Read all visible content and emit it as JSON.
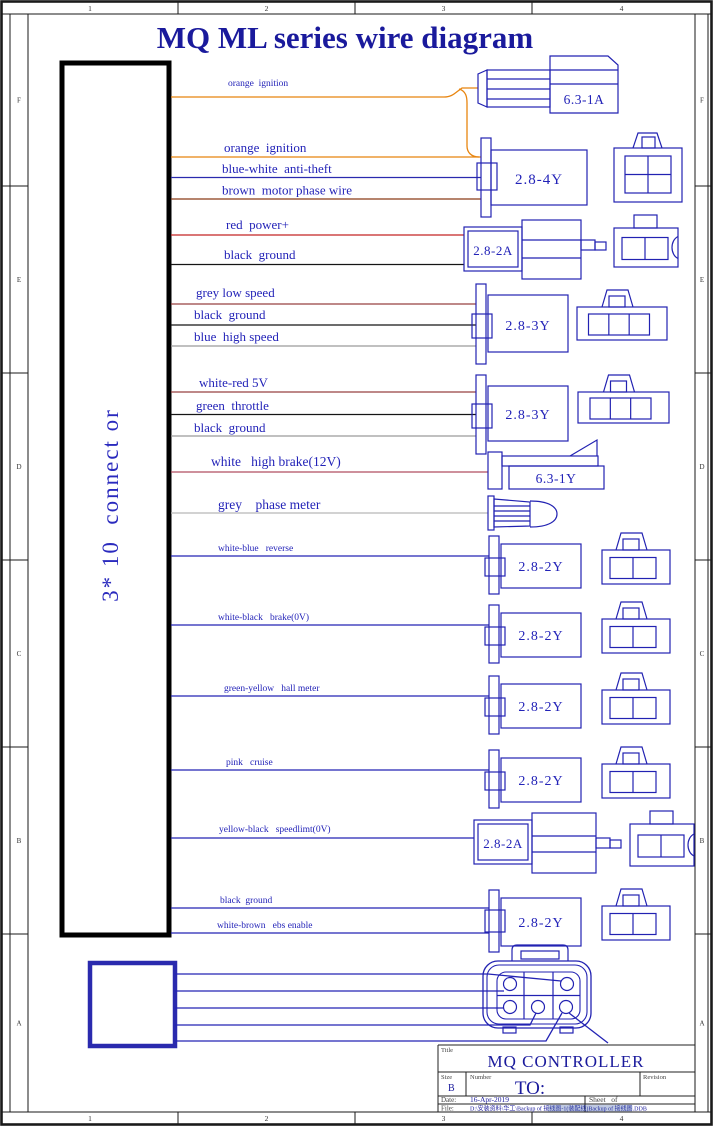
{
  "sheet": {
    "title": "MQ ML series wire diagram"
  },
  "frame": {
    "columns": [
      "1",
      "2",
      "3",
      "4"
    ],
    "rows": [
      "F",
      "E",
      "D",
      "C",
      "B",
      "A"
    ]
  },
  "main_connector": {
    "label": "3* 10  connect or"
  },
  "colors": {
    "line": "#2222b2",
    "label_text": "#2323b8",
    "title_text": "#1a1a9c",
    "frame_line": "#1a1a1a",
    "orange": "#e8850f",
    "navy": "#2a2aae",
    "brown": "#8a3a16",
    "red": "#c42525",
    "black": "#151515",
    "dark_red": "#984040",
    "grey": "#9a9a9a",
    "light_grey": "#b8b8b8",
    "crimson": "#b14e62",
    "blue": "#2323b4"
  },
  "wires": [
    {
      "label": "orange  ignition",
      "color": "#e8850f"
    },
    {
      "label": "orange  ignition",
      "color": "#e8850f"
    },
    {
      "label": "blue-white  anti-theft",
      "color": "#2a2aae"
    },
    {
      "label": "brown  motor phase wire",
      "color": "#8a3a16"
    },
    {
      "label": "red  power+",
      "color": "#c42525"
    },
    {
      "label": "black  ground",
      "color": "#151515"
    },
    {
      "label": "grey low speed",
      "color": "#984040"
    },
    {
      "label": "black  ground",
      "color": "#151515"
    },
    {
      "label": "blue  high speed",
      "color": "#9a9a9a"
    },
    {
      "label": "white-red 5V",
      "color": "#984040"
    },
    {
      "label": "green  throttle",
      "color": "#151515"
    },
    {
      "label": "black  ground",
      "color": "#9a9a9a"
    },
    {
      "label": "white   high brake(12V)",
      "color": "#b14e62"
    },
    {
      "label": "grey    phase meter",
      "color": "#b8b8b8"
    },
    {
      "label": "white-blue   reverse",
      "color": "#2323b4"
    },
    {
      "label": "white-black   brake(0V)",
      "color": "#2323b4"
    },
    {
      "label": "green-yellow   hall meter",
      "color": "#2323b4"
    },
    {
      "label": "pink   cruise",
      "color": "#2323b4"
    },
    {
      "label": "yellow-black   speedlimt(0V)",
      "color": "#2323b4"
    },
    {
      "label": "black  ground",
      "color": "#2323b4"
    },
    {
      "label": "white-brown   ebs enable",
      "color": "#2323b4"
    }
  ],
  "connectors": {
    "spade_a": "6.3-1A",
    "four_y": "2.8-4Y",
    "two_a_power": "2.8-2A",
    "three_y_speed": "2.8-3Y",
    "three_y_throttle": "2.8-3Y",
    "spade_y": "6.3-1Y",
    "two_y_reverse": "2.8-2Y",
    "two_y_brake": "2.8-2Y",
    "two_y_hall": "2.8-2Y",
    "two_y_cruise": "2.8-2Y",
    "two_a_speedlimit": "2.8-2A",
    "two_y_ebs": "2.8-2Y"
  },
  "title_block": {
    "title_label": "Title",
    "title": "MQ CONTROLLER",
    "size_label": "Size",
    "size": "B",
    "number_label": "Number",
    "number": "TO:",
    "revision_label": "Revision",
    "date_label": "Date:",
    "date": "16-Apr-2019",
    "sheet_label": "Sheet   of",
    "file_label": "File:",
    "file": "D:\\安装资料\\华工\\Backup of 接线图-1(装配线)Backup of 接线图.DDB"
  }
}
